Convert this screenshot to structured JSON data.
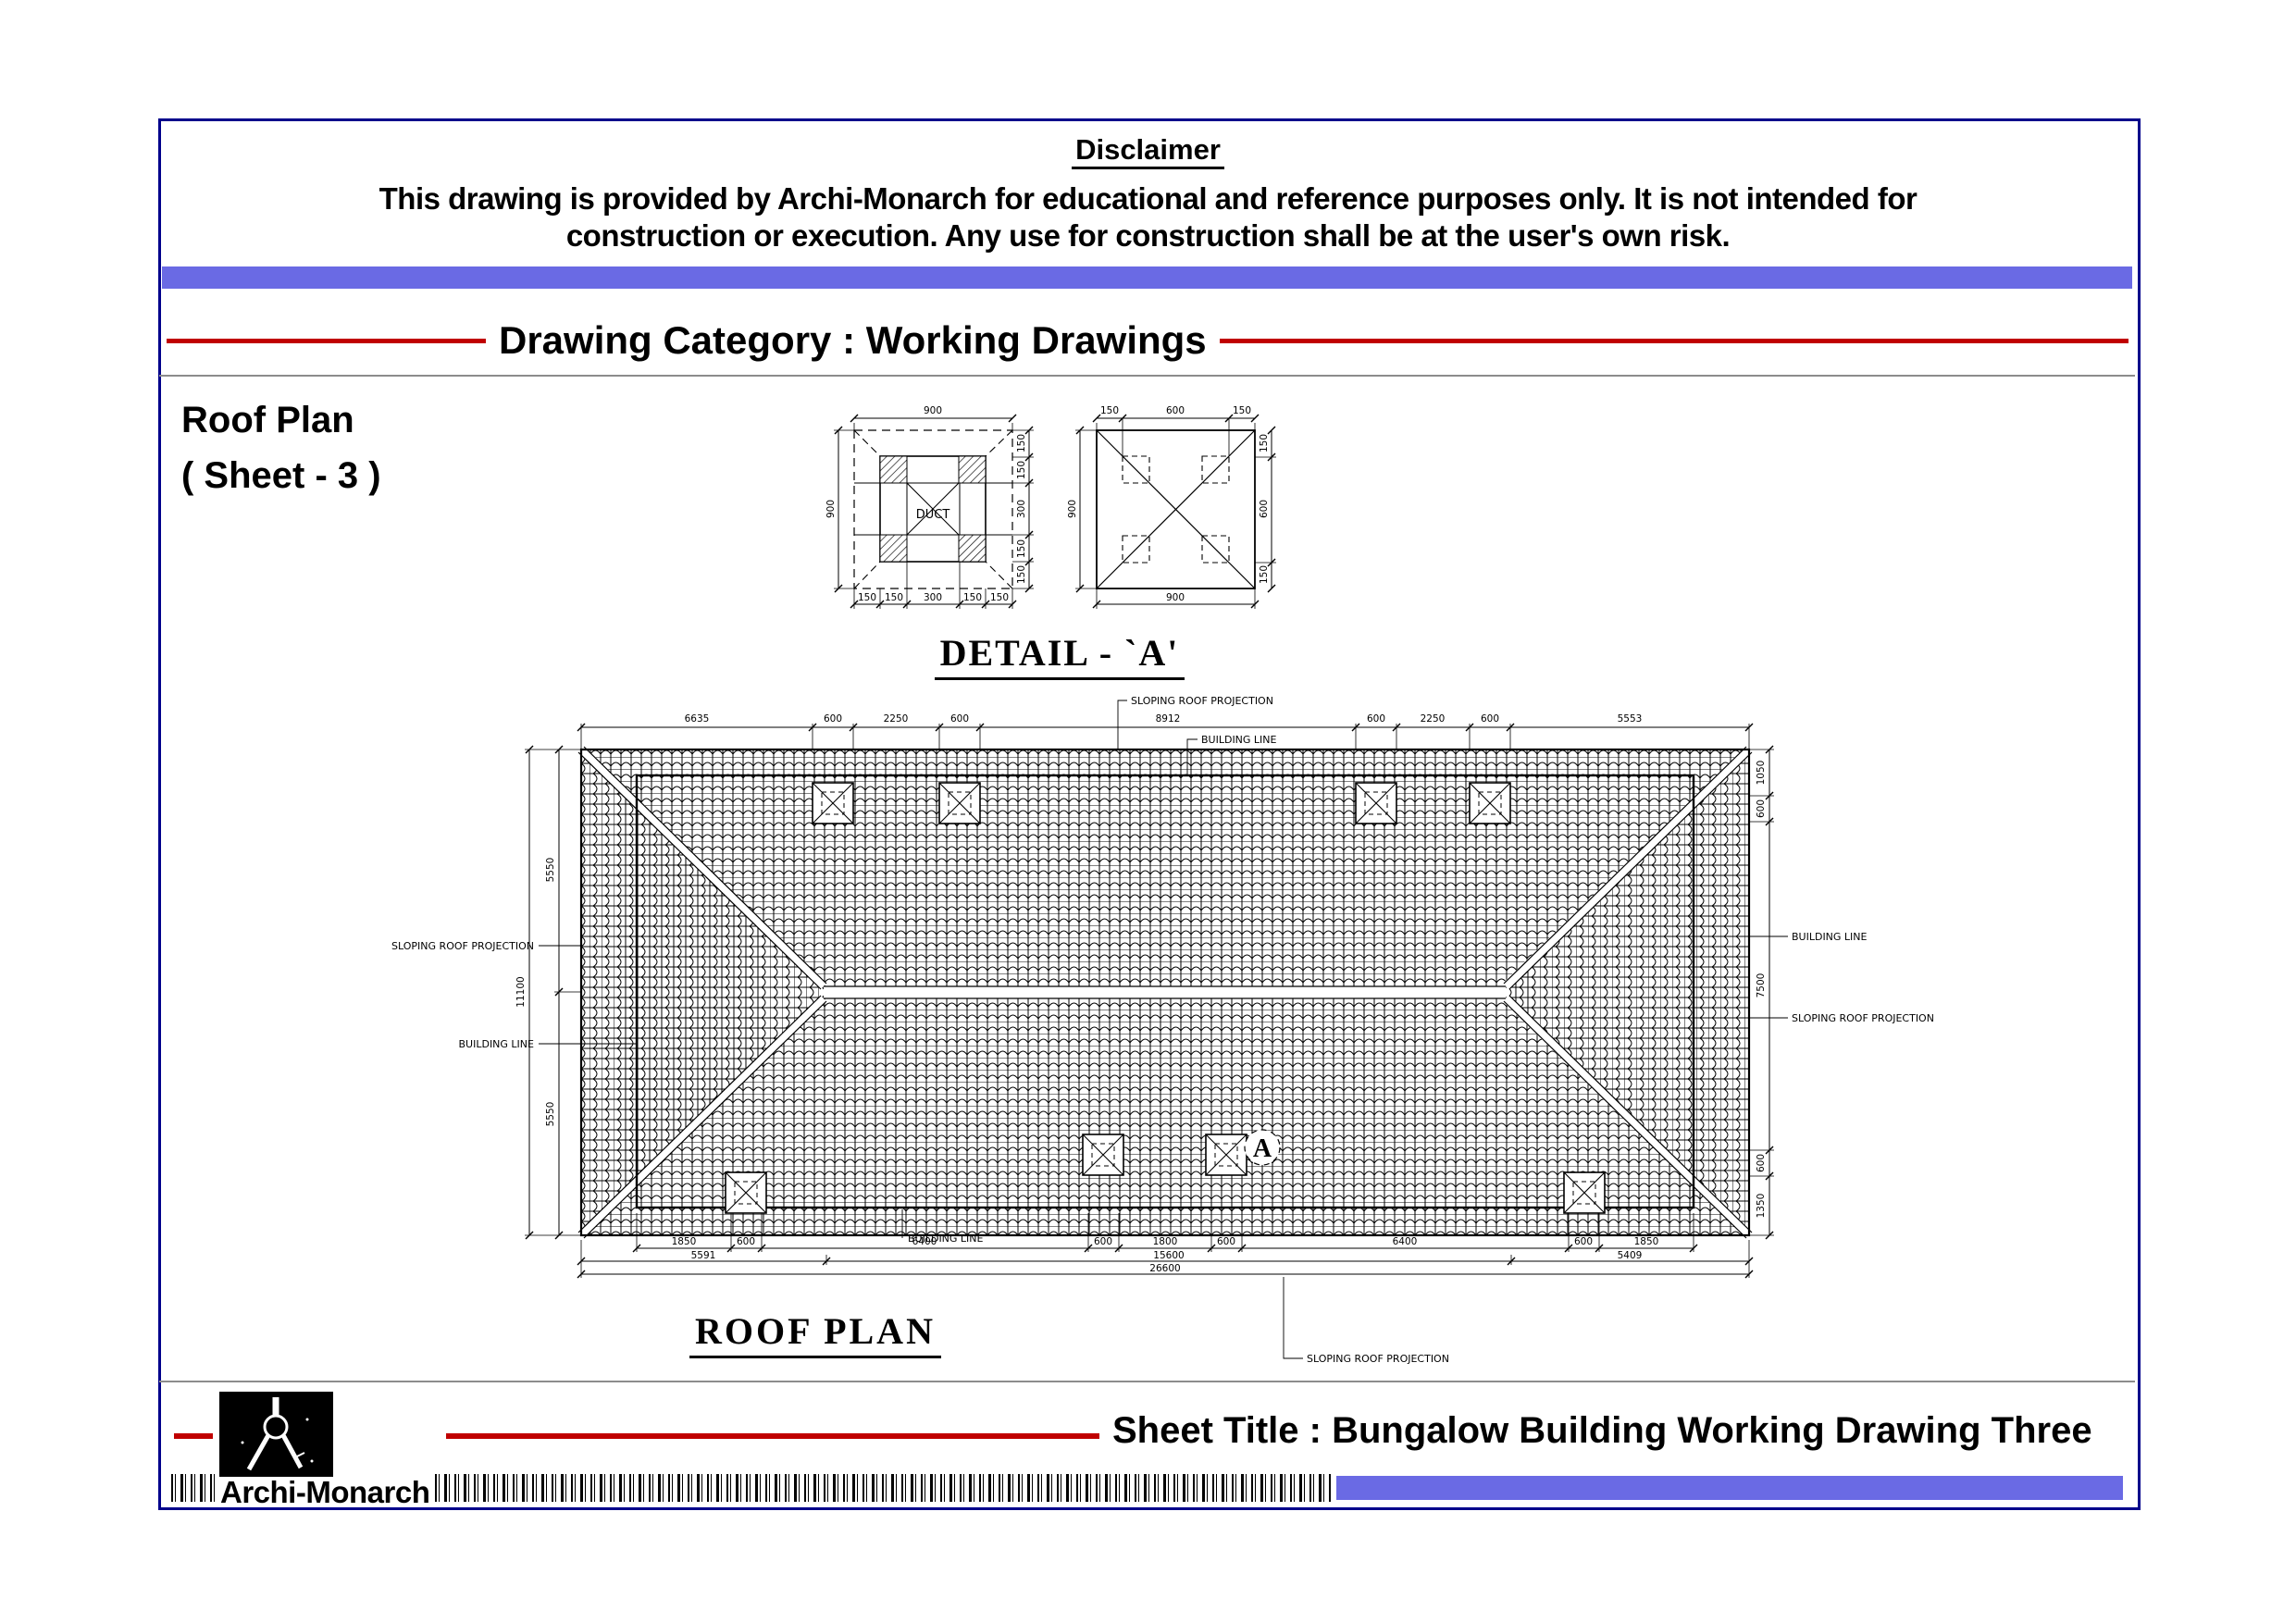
{
  "colors": {
    "navy": "#00008b",
    "bar": "#6a6ae4",
    "red": "#c00000"
  },
  "disclaimer": {
    "title": "Disclaimer",
    "line1": "This drawing is provided by Archi-Monarch for educational and reference purposes only. It is not intended for",
    "line2": "construction or execution. Any use for construction shall be at the user's own risk."
  },
  "category": {
    "label": "Drawing Category : Working Drawings"
  },
  "sheet": {
    "heading": "Roof Plan",
    "subheading": "( Sheet - 3 )"
  },
  "detail_a": {
    "title": "DETAIL  - `A'",
    "duct_label": "DUCT",
    "left_view": {
      "top": "900",
      "side": "900",
      "right": [
        "150",
        "150",
        "300",
        "150",
        "150"
      ],
      "bottom": [
        "150",
        "150",
        "300",
        "150",
        "150"
      ]
    },
    "right_view": {
      "top": [
        "150",
        "600",
        "150"
      ],
      "side": [
        "150",
        "600",
        "150"
      ],
      "left": "900",
      "bottom": "900"
    }
  },
  "roof_plan": {
    "title": "ROOF PLAN",
    "marker": "A",
    "label_sloping": "SLOPING ROOF PROJECTION",
    "label_building": "BUILDING LINE",
    "dims_top": [
      "6635",
      "600",
      "2250",
      "600",
      "8912",
      "600",
      "2250",
      "600",
      "5553"
    ],
    "dims_left_outer": "11100",
    "dims_left_inner": [
      "5550",
      "5550"
    ],
    "dims_right": [
      "1050",
      "600",
      "7500",
      "600",
      "1350"
    ],
    "dims_bottom_row1": [
      "1850",
      "600",
      "6400",
      "600",
      "1800",
      "600",
      "6400",
      "600",
      "1850"
    ],
    "dims_bottom_row2": [
      "5591",
      "15600",
      "5409"
    ],
    "dims_bottom_total": "26600"
  },
  "footer": {
    "brand": "Archi-Monarch",
    "sheet_title": "Sheet Title : Bungalow Building Working Drawing Three"
  }
}
